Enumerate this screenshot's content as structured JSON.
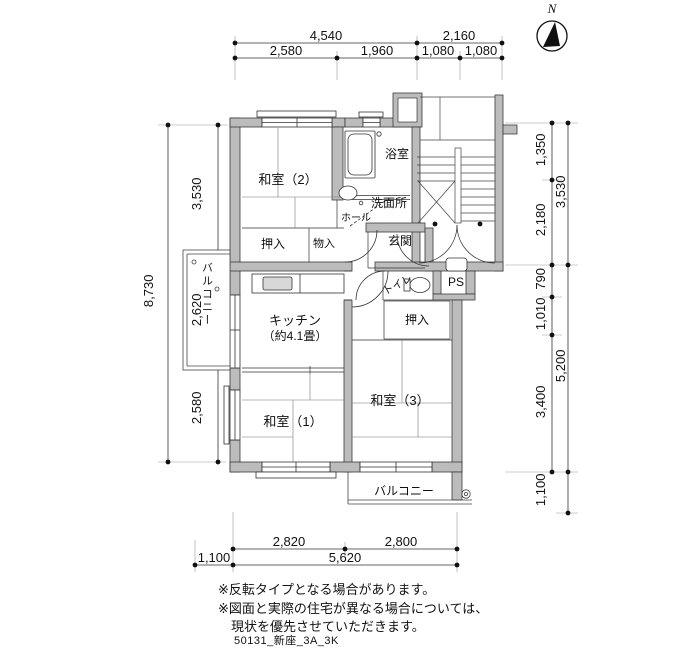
{
  "north": {
    "label": "N"
  },
  "rooms": {
    "washitsu2": "和室（2）",
    "bath": "浴室",
    "washroom": "洗面所",
    "hall": "ホール",
    "genkan": "玄関",
    "closet_top": "押入",
    "storage": "物入",
    "balcony_left": "バルコニー",
    "kitchen": "キッチン",
    "kitchen_size": "（約4.1畳）",
    "toilet": "トイレ",
    "pipe_space": "PS",
    "closet_right": "押入",
    "washitsu1": "和室（1）",
    "washitsu3": "和室（3）",
    "balcony_bottom": "バルコニー"
  },
  "dims": {
    "top_row1": [
      "4,540",
      "2,160"
    ],
    "top_row2": [
      "2,580",
      "1,960",
      "1,080",
      "1,080"
    ],
    "left_outer": "8,730",
    "left_inner": [
      "3,530",
      "2,620",
      "2,580"
    ],
    "right_inner": [
      "1,350",
      "2,180",
      "790",
      "1,010",
      "3,400",
      "1,100"
    ],
    "right_outer": [
      "3,530",
      "5,200"
    ],
    "bottom_row1": [
      "2,820",
      "2,800"
    ],
    "bottom_row2": [
      "1,100",
      "5,620"
    ]
  },
  "notes": [
    "※反転タイプとなる場合があります。",
    "※図面と実際の住宅が異なる場合については、",
    "現状を優先させていただきます。"
  ],
  "footer_code": "50131_新座_3A_3K"
}
